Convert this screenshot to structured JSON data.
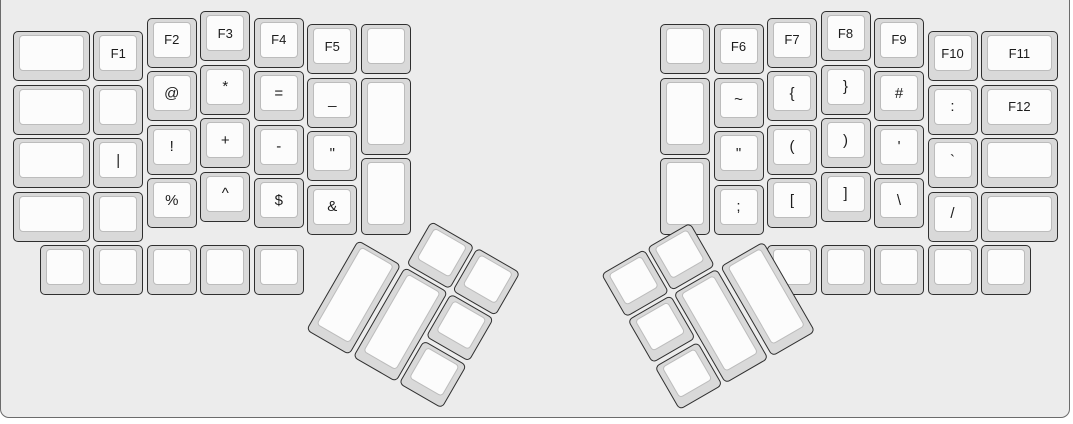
{
  "board": {
    "page_background": "#ffffff",
    "background": "#ececec",
    "border_color": "#6b6b6b"
  },
  "key_style": {
    "rim_color": "#d9d9d9",
    "top_color": "#fcfcfc",
    "outline_color": "#2f2f2f",
    "top_outline_color": "#bcbcbc",
    "text_color": "#1c1c1c"
  },
  "layout": {
    "unit_px": 53.5,
    "key_gap_px": 3.5,
    "origin_y_px": 11
  },
  "symbol_names": {
    "@": "at",
    "*": "asterisk",
    "=": "equals",
    "_": "underscore",
    "|": "pipe",
    "!": "exclamation",
    "+": "plus",
    "-": "minus",
    "\"": "double-quote",
    "%": "percent",
    "^": "caret",
    "$": "dollar",
    "&": "ampersand",
    "~": "tilde",
    "{": "open-brace",
    "}": "close-brace",
    "#": "hash",
    ":": "colon",
    "(": "open-paren",
    ")": "close-paren",
    "'": "apostrophe",
    "`": "backtick",
    ";": "semicolon",
    "[": "open-bracket",
    "]": "close-bracket",
    "\\": "backslash",
    "/": "slash"
  },
  "groups": [
    {
      "name": "left-main",
      "origin_px": [
        13,
        11
      ],
      "rotation_deg": 0,
      "keys": [
        {
          "x": 0,
          "y": 0.375,
          "w": 1.5,
          "label": ""
        },
        {
          "x": 0,
          "y": 1.375,
          "w": 1.5,
          "label": ""
        },
        {
          "x": 0,
          "y": 2.375,
          "w": 1.5,
          "label": ""
        },
        {
          "x": 0,
          "y": 3.375,
          "w": 1.5,
          "label": ""
        },
        {
          "x": 1.5,
          "y": 0.375,
          "label": "F1"
        },
        {
          "x": 1.5,
          "y": 1.375,
          "label": ""
        },
        {
          "x": 1.5,
          "y": 2.375,
          "label": "|"
        },
        {
          "x": 1.5,
          "y": 3.375,
          "label": ""
        },
        {
          "x": 2.5,
          "y": 0.125,
          "label": "F2"
        },
        {
          "x": 2.5,
          "y": 1.125,
          "label": "@"
        },
        {
          "x": 2.5,
          "y": 2.125,
          "label": "!"
        },
        {
          "x": 2.5,
          "y": 3.125,
          "label": "%"
        },
        {
          "x": 3.5,
          "y": 0,
          "label": "F3"
        },
        {
          "x": 3.5,
          "y": 1,
          "label": "*"
        },
        {
          "x": 3.5,
          "y": 2,
          "label": "+"
        },
        {
          "x": 3.5,
          "y": 3,
          "label": "^"
        },
        {
          "x": 4.5,
          "y": 0.125,
          "label": "F4"
        },
        {
          "x": 4.5,
          "y": 1.125,
          "label": "="
        },
        {
          "x": 4.5,
          "y": 2.125,
          "label": "-"
        },
        {
          "x": 4.5,
          "y": 3.125,
          "label": "$"
        },
        {
          "x": 5.5,
          "y": 0.25,
          "label": "F5"
        },
        {
          "x": 5.5,
          "y": 1.25,
          "label": "_"
        },
        {
          "x": 5.5,
          "y": 2.25,
          "label": "\""
        },
        {
          "x": 5.5,
          "y": 3.25,
          "label": "&"
        },
        {
          "x": 6.5,
          "y": 0.25,
          "label": ""
        },
        {
          "x": 6.5,
          "y": 1.25,
          "h": 1.5,
          "label": ""
        },
        {
          "x": 6.5,
          "y": 2.75,
          "h": 1.5,
          "label": ""
        },
        {
          "x": 0.5,
          "y": 4.375,
          "label": ""
        },
        {
          "x": 1.5,
          "y": 4.375,
          "label": ""
        },
        {
          "x": 2.5,
          "y": 4.375,
          "label": ""
        },
        {
          "x": 3.5,
          "y": 4.375,
          "label": ""
        },
        {
          "x": 4.5,
          "y": 4.375,
          "label": ""
        }
      ]
    },
    {
      "name": "right-main",
      "origin_px": [
        660,
        11
      ],
      "rotation_deg": 0,
      "keys": [
        {
          "x": 0,
          "y": 0.25,
          "label": ""
        },
        {
          "x": 0,
          "y": 1.25,
          "h": 1.5,
          "label": ""
        },
        {
          "x": 0,
          "y": 2.75,
          "h": 1.5,
          "label": ""
        },
        {
          "x": 1,
          "y": 0.25,
          "label": "F6"
        },
        {
          "x": 1,
          "y": 1.25,
          "label": "~"
        },
        {
          "x": 1,
          "y": 2.25,
          "label": "\""
        },
        {
          "x": 1,
          "y": 3.25,
          "label": ";"
        },
        {
          "x": 2,
          "y": 0.125,
          "label": "F7"
        },
        {
          "x": 2,
          "y": 1.125,
          "label": "{"
        },
        {
          "x": 2,
          "y": 2.125,
          "label": "("
        },
        {
          "x": 2,
          "y": 3.125,
          "label": "["
        },
        {
          "x": 3,
          "y": 0,
          "label": "F8"
        },
        {
          "x": 3,
          "y": 1,
          "label": "}"
        },
        {
          "x": 3,
          "y": 2,
          "label": ")"
        },
        {
          "x": 3,
          "y": 3,
          "label": "]"
        },
        {
          "x": 4,
          "y": 0.125,
          "label": "F9"
        },
        {
          "x": 4,
          "y": 1.125,
          "label": "#"
        },
        {
          "x": 4,
          "y": 2.125,
          "label": "'"
        },
        {
          "x": 4,
          "y": 3.125,
          "label": "\\"
        },
        {
          "x": 5,
          "y": 0.375,
          "label": "F10"
        },
        {
          "x": 5,
          "y": 1.375,
          "label": ":"
        },
        {
          "x": 5,
          "y": 2.375,
          "label": "`"
        },
        {
          "x": 5,
          "y": 3.375,
          "label": "/"
        },
        {
          "x": 6,
          "y": 0.375,
          "w": 1.5,
          "label": "F11"
        },
        {
          "x": 6,
          "y": 1.375,
          "w": 1.5,
          "label": "F12"
        },
        {
          "x": 6,
          "y": 2.375,
          "w": 1.5,
          "label": ""
        },
        {
          "x": 6,
          "y": 3.375,
          "w": 1.5,
          "label": ""
        },
        {
          "x": 2,
          "y": 4.375,
          "label": ""
        },
        {
          "x": 3,
          "y": 4.375,
          "label": ""
        },
        {
          "x": 4,
          "y": 4.375,
          "label": ""
        },
        {
          "x": 5,
          "y": 4.375,
          "label": ""
        },
        {
          "x": 6,
          "y": 4.375,
          "label": ""
        }
      ]
    },
    {
      "name": "left-thumb-cluster",
      "origin_px": [
        358,
        240
      ],
      "rotation_deg": 30,
      "keys": [
        {
          "x": 1,
          "y": -1,
          "label": ""
        },
        {
          "x": 2,
          "y": -1,
          "label": ""
        },
        {
          "x": 0,
          "y": 0,
          "h": 2,
          "label": ""
        },
        {
          "x": 1,
          "y": 0,
          "h": 2,
          "label": ""
        },
        {
          "x": 2,
          "y": 0,
          "label": ""
        },
        {
          "x": 2,
          "y": 1,
          "label": ""
        }
      ]
    },
    {
      "name": "right-thumb-cluster",
      "origin_px": [
        766,
        240
      ],
      "rotation_deg": -30,
      "keys": [
        {
          "x": -3,
          "y": -1,
          "label": ""
        },
        {
          "x": -2,
          "y": -1,
          "label": ""
        },
        {
          "x": -3,
          "y": 0,
          "label": ""
        },
        {
          "x": -2,
          "y": 0,
          "h": 2,
          "label": ""
        },
        {
          "x": -1,
          "y": 0,
          "h": 2,
          "label": ""
        },
        {
          "x": -3,
          "y": 1,
          "label": ""
        }
      ]
    }
  ]
}
